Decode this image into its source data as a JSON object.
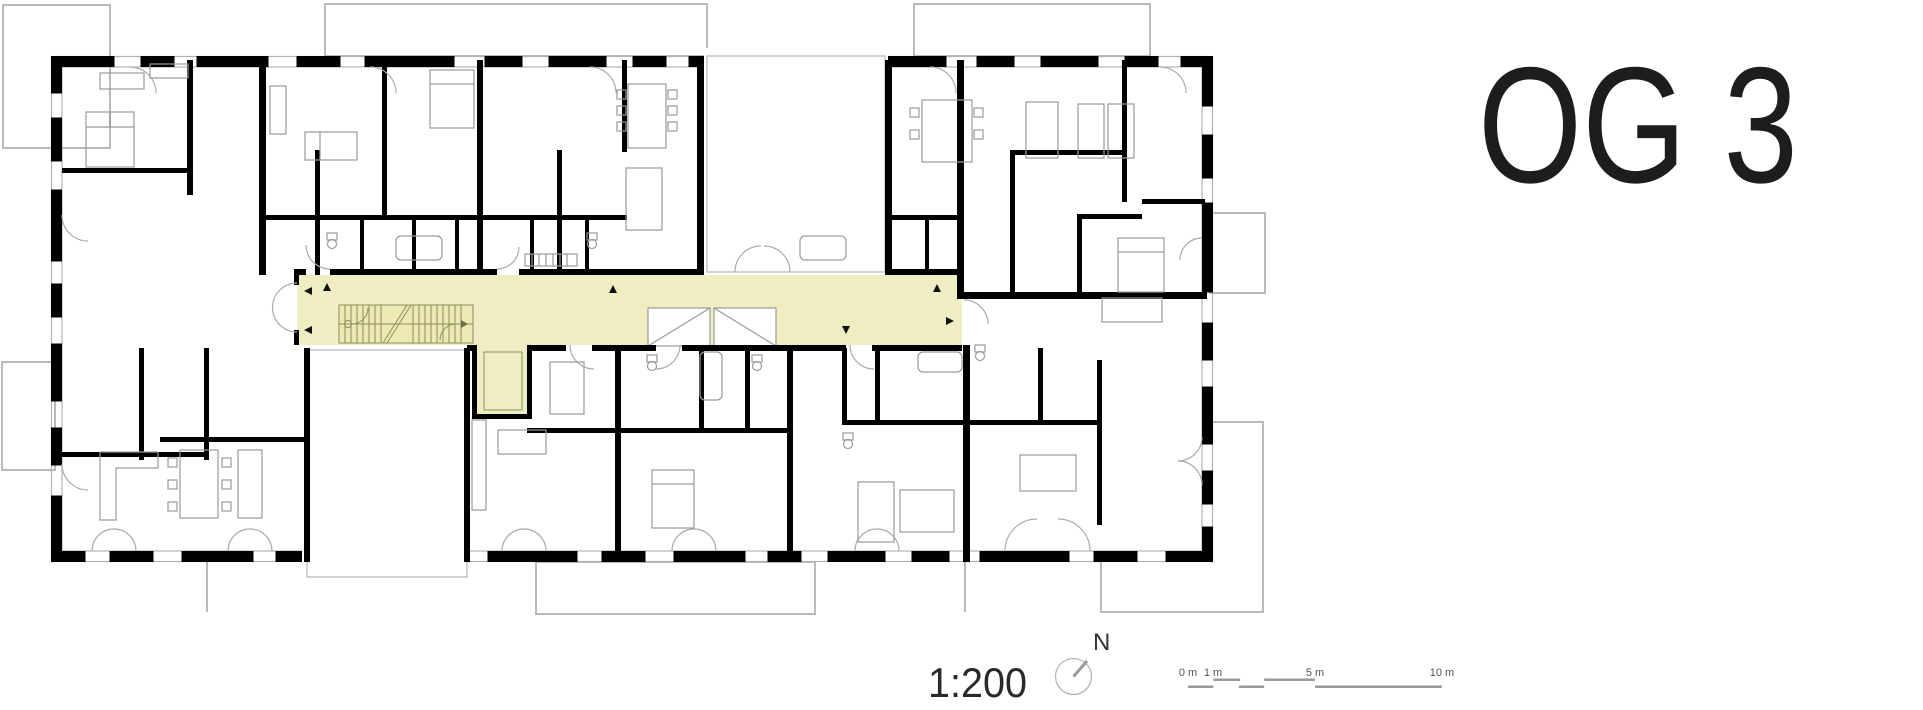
{
  "page": {
    "width": 1923,
    "height": 710,
    "background": "#ffffff"
  },
  "title": {
    "text": "OG 3"
  },
  "legend": {
    "scale_text": "1:200",
    "north_label": "N",
    "scale_bar_labels": [
      "0 m",
      "1 m",
      "5 m",
      "10 m"
    ]
  },
  "colors": {
    "walls": "#000000",
    "corridor_highlight": "#efeec3",
    "stair_detail": "#8f8c60",
    "furniture": "#9a9a9a",
    "balcony_outline": "#b9b9b9",
    "door_arc": "#ababab",
    "scale_bar": "#9a9a9a",
    "text": "#1d1d1d"
  }
}
